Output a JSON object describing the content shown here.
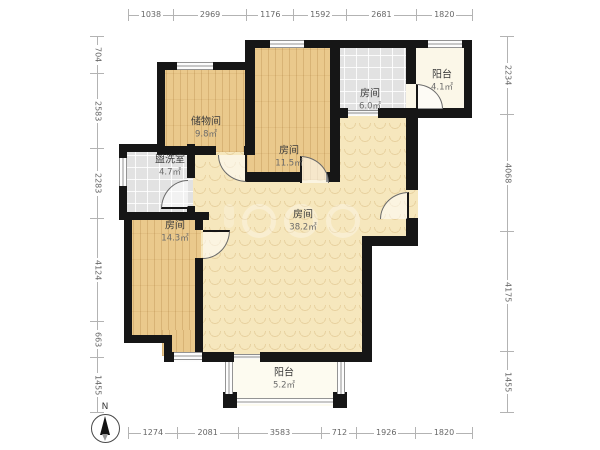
{
  "plan": {
    "rooms": [
      {
        "id": "storage",
        "name": "储物间",
        "area": "9.8㎡"
      },
      {
        "id": "room-small",
        "name": "房间",
        "area": "6.0㎡"
      },
      {
        "id": "balcony-top",
        "name": "阳台",
        "area": "4.1㎡"
      },
      {
        "id": "washroom",
        "name": "盥洗室",
        "area": "4.7㎡"
      },
      {
        "id": "room-mid",
        "name": "房间",
        "area": "11.5㎡"
      },
      {
        "id": "room-main",
        "name": "房间",
        "area": "38.2㎡"
      },
      {
        "id": "room-left",
        "name": "房间",
        "area": "14.3㎡"
      },
      {
        "id": "balcony-bottom",
        "name": "阳台",
        "area": "5.2㎡"
      }
    ],
    "compass_label": "N"
  },
  "dimensions": {
    "top": [
      1038,
      2969,
      1176,
      1592,
      2681,
      1820
    ],
    "bottom": [
      1274,
      2081,
      3583,
      712,
      1926,
      1820
    ],
    "left": [
      704,
      2583,
      2283,
      4124,
      663,
      1455
    ],
    "right": [
      2234,
      4068,
      4175,
      1455
    ]
  },
  "colors": {
    "wall": "#161616",
    "wood_floor": "#eac98c",
    "tile_floor": "#e2e2e2",
    "main_floor": "#f6e7bd",
    "balcony_floor": "#fbf7e8",
    "dimension_line": "#b3b3b3",
    "dimension_text": "#676767"
  }
}
